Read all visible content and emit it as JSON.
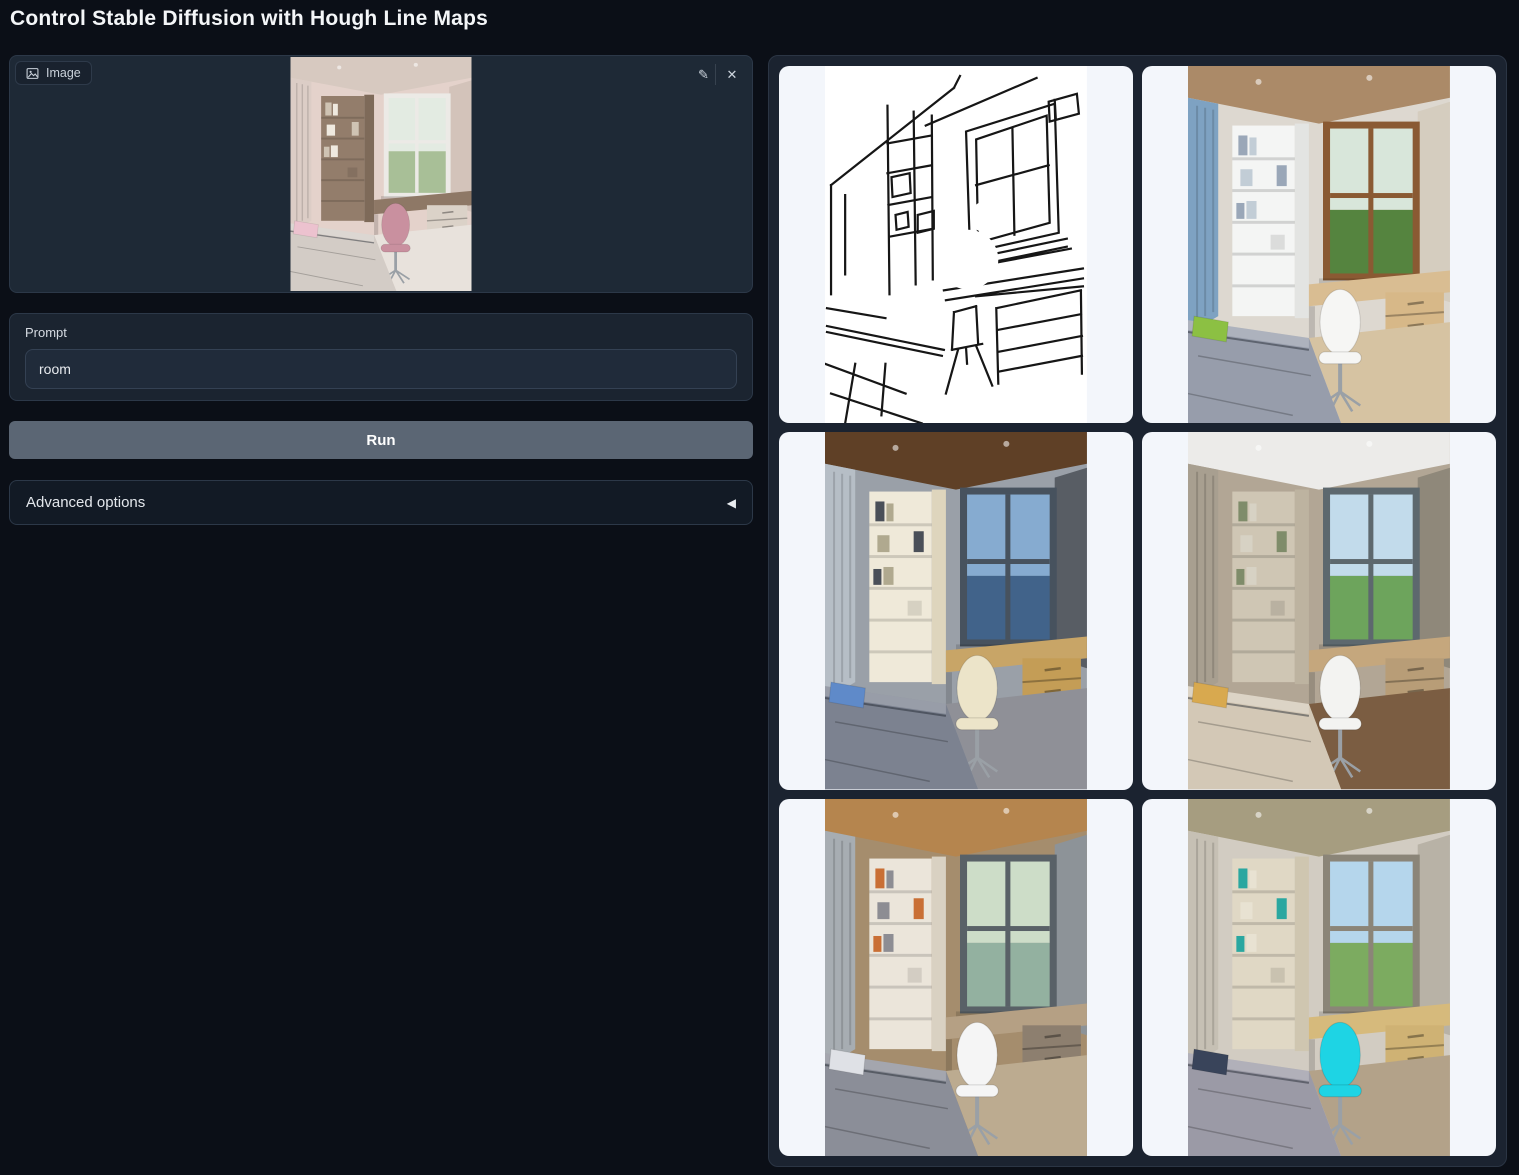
{
  "page": {
    "title": "Control Stable Diffusion with Hough Line Maps"
  },
  "input_image": {
    "label": "Image",
    "alt": "Uploaded photo: small bedroom with corner bookshelf, desk under a bright window, pink desk chair and a bed with a pink pillow",
    "colors": {
      "ceiling": "#d7c9c0",
      "wall": "#e4d2cb",
      "curtainL": "#dccdc6",
      "curtainR": "#d3c3ba",
      "shelf": "#937d6b",
      "shelfSide": "#7e6a59",
      "frame": "#eceae6",
      "viewTop": "#e3ebe2",
      "viewBottom": "#a8bf97",
      "desk": "#8e7866",
      "drawers": "#dbd2c8",
      "chair": "#c9909f",
      "bed": "#d3ccc6",
      "pillow": "#ecc2cf",
      "floor": "#e8e2dc",
      "books": "#cfc3b3",
      "books2": "#efe9df"
    }
  },
  "prompt": {
    "label": "Prompt",
    "value": "room"
  },
  "run_button": {
    "label": "Run"
  },
  "advanced_options": {
    "label": "Advanced options",
    "collapse_glyph": "◀"
  },
  "icons": {
    "edit_glyph": "✎",
    "clear_glyph": "✕",
    "image_icon": "picture-frame"
  },
  "gallery": {
    "items": [
      {
        "kind": "hough-line-map",
        "alt": "Black-on-white Hough line (M-LSD) map of the bedroom: window at right, bookshelf at left, desk drawers and bed edges",
        "colors": {
          "ink": "#161616",
          "paper": "#ffffff"
        }
      },
      {
        "kind": "generated",
        "alt": "Generated bedroom, daylight: blue curtains, white shelving, wooden window with green trees, white chair, gray bed with green pillow",
        "colors": {
          "ceiling": "#ab8a68",
          "wall": "#ddd8d0",
          "curtainL": "#7ea2c2",
          "curtainR": "#d5cdbf",
          "shelf": "#f4f5f4",
          "shelfSide": "#e3e4e2",
          "frame": "#8a5a33",
          "viewTop": "#d8e6da",
          "viewBottom": "#55843f",
          "desk": "#d9bd92",
          "drawers": "#d7b888",
          "chair": "#f6f6f4",
          "bed": "#979dab",
          "pillow": "#8cc043",
          "floor": "#d6c3a2",
          "books": "#9aa7b8",
          "books2": "#c2cdd6"
        }
      },
      {
        "kind": "generated",
        "alt": "Generated bedroom, evening: dark wood ceiling, gray drapes, sea-and-sky window, cream shelving and chair, gray bed with blue pillow",
        "colors": {
          "ceiling": "#5f4026",
          "wall": "#9aa0a8",
          "curtainL": "#b6bec6",
          "curtainR": "#585d64",
          "shelf": "#efe9d9",
          "shelfSide": "#ded5bd",
          "frame": "#47525e",
          "viewTop": "#86abd0",
          "viewBottom": "#41638a",
          "desk": "#c8a567",
          "drawers": "#c49d56",
          "chair": "#ece4c9",
          "bed": "#7c8290",
          "pillow": "#5f8ac9",
          "floor": "#8f9097",
          "books": "#4a4f58",
          "books2": "#b0a98f"
        }
      },
      {
        "kind": "generated",
        "alt": "Generated bedroom, daylight: white ceiling with spotlights, tan walls, green trees outside, white chair, beige bed with yellow pillow, wooden floor",
        "colors": {
          "ceiling": "#ecebe9",
          "wall": "#b2a695",
          "curtainL": "#a89f90",
          "curtainR": "#8f887a",
          "shelf": "#cfc6b4",
          "shelfSide": "#bdb3a0",
          "frame": "#5d686e",
          "viewTop": "#c2dbeb",
          "viewBottom": "#6da45c",
          "desk": "#c5a77d",
          "drawers": "#b89d77",
          "chair": "#f3f3f1",
          "bed": "#d3c8b6",
          "pillow": "#d8a94f",
          "floor": "#7b5d42",
          "books": "#7f8c6a",
          "books2": "#d7d2c4"
        }
      },
      {
        "kind": "generated",
        "alt": "Generated bedroom: warm wood ceiling, gray curtains, greenery above the window, white swivel chair, patterned gray bed, light wood floor",
        "colors": {
          "ceiling": "#b5854e",
          "wall": "#a58d6d",
          "curtainL": "#a7adb2",
          "curtainR": "#8d9398",
          "shelf": "#ebe5da",
          "shelfSide": "#d9d1c2",
          "frame": "#596167",
          "viewTop": "#cdddc8",
          "viewBottom": "#93b1a0",
          "desk": "#b5a084",
          "drawers": "#8d7f6f",
          "chair": "#f5f5f5",
          "bed": "#8b8e98",
          "pillow": "#dfe1e6",
          "floor": "#bcab90",
          "books": "#c96f35",
          "books2": "#8d8d93"
        }
      },
      {
        "kind": "generated",
        "alt": "Generated bedroom: concrete-toned ceiling, teal books on shelves, bright sky window, vivid cyan chair at a wooden desk, gray bed with dark patterned pillow",
        "colors": {
          "ceiling": "#a69d80",
          "wall": "#d2ccc2",
          "curtainL": "#c6c0b4",
          "curtainR": "#b8b2a6",
          "shelf": "#e0d8c5",
          "shelfSide": "#cfc6b0",
          "frame": "#8b8578",
          "viewTop": "#b5d6ec",
          "viewBottom": "#7cab60",
          "desk": "#d6ba7c",
          "drawers": "#cfb274",
          "chair": "#1ed4e4",
          "bed": "#9b9aa6",
          "pillow": "#39445a",
          "floor": "#b3a289",
          "books": "#2aa7a0",
          "books2": "#e8e2d2"
        }
      }
    ]
  }
}
